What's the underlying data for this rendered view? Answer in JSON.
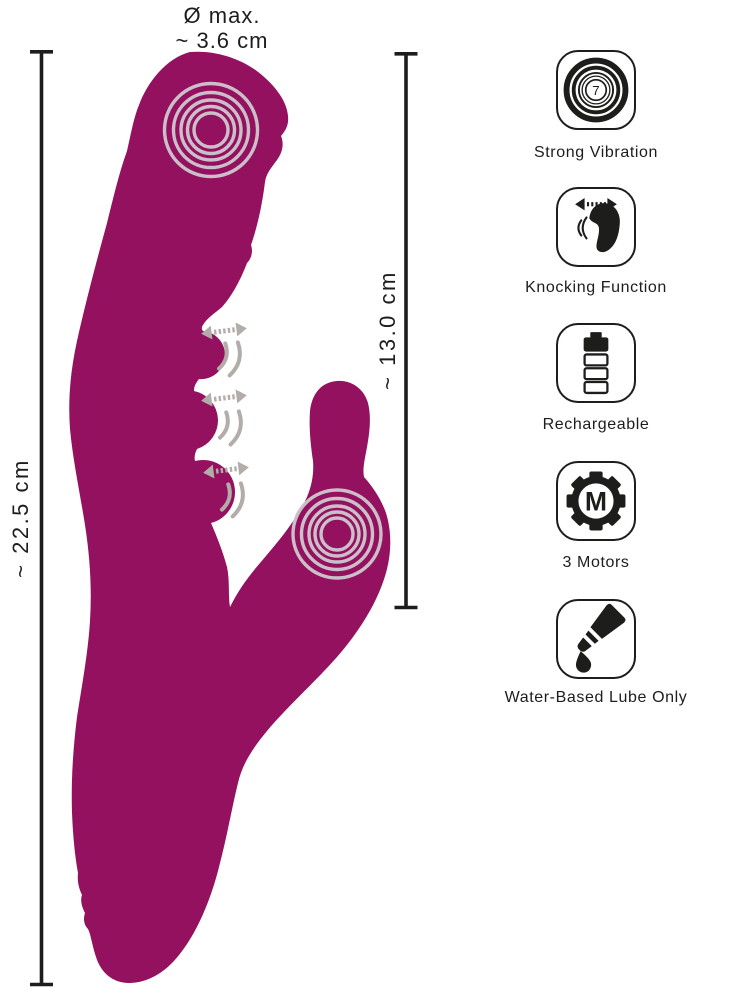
{
  "measurements": {
    "diameter": {
      "line1": "Ø max.",
      "line2": "~ 3.6 cm"
    },
    "total_length": "~ 22.5 cm",
    "insertable_length": "~ 13.0 cm"
  },
  "features": [
    {
      "icon": "strong-vibration-icon",
      "label": "Strong Vibration",
      "badge": "7"
    },
    {
      "icon": "knocking-function-icon",
      "label": "Knocking Function"
    },
    {
      "icon": "rechargeable-icon",
      "label": "Rechargeable"
    },
    {
      "icon": "motors-icon",
      "label": "3 Motors",
      "monogram": "M"
    },
    {
      "icon": "water-based-lube-icon",
      "label": "Water-Based Lube Only"
    }
  ],
  "colors": {
    "product": "#93115F",
    "swirl": "#CBBFC9",
    "annotation_gray": "#B3ADAA",
    "ink": "#1D1D1B"
  }
}
